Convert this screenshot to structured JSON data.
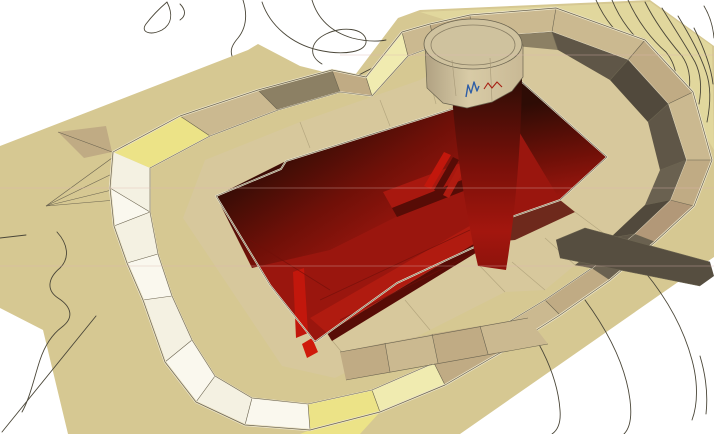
{
  "scene": {
    "kind": "3d-terrain-excavation-model",
    "description": "Isometric CAD rendering of a terrain surface with a perimeter berm, a deep rectangular excavation pit shown in red with stepped benches, and a circular shaft structure at the top edge of the pit; thin topographic contour lines cross the surrounding ground.",
    "features": {
      "terrain_surface": "tan triangulated ground surface",
      "contour_lines": "thin dark topographic contours",
      "berm_ring": "faceted embankment surrounding the excavation",
      "inner_slope": "shadowed dark olive inner slope on far side",
      "outer_slope_left": "bright white and yellow lit facets on near side",
      "excavation_pit": "deep pit with dark red floor and stepped ramps",
      "circular_shaft": "cylindrical shaft with tan collar dropping into the pit",
      "survey_marks": "small blue and red zigzag marks at shaft wall top"
    },
    "colors": {
      "bg": "#ffffff",
      "terrain": "#d6c892",
      "terrainPale": "#e3d99f",
      "bench": "#d7c89c",
      "benchLine": "#b5a77f",
      "outline": "#6b6450",
      "contour": "#4a4638",
      "toeLight": "#ece4c8",
      "crest": "#efe8d2",
      "white1": "#f4f1e2",
      "white2": "#faf8ee",
      "yellow": "#ece387",
      "yellowPale": "#f0ebb0",
      "tan1": "#cbb990",
      "tan2": "#c0ab84",
      "tan3": "#b29878",
      "brown1": "#8c8064",
      "darkOlive1": "#5f5647",
      "darkOlive2": "#51493c",
      "darkOlive3": "#6a6150",
      "rampDark": "#564e40",
      "rampLight": "#9a8e6e",
      "pitBase": "#9a160e",
      "pitBright": "#c2170c",
      "pitBright2": "#cf1a0b",
      "stepTop": "#b01b10",
      "stepTop2": "#a8180f",
      "stepSide": "#570c06",
      "wallDark": "#2e0c05",
      "wallMid": "#6f1008",
      "floorLine": "#70100a",
      "shaftTop": "#330d06",
      "shaftMid": "#7a1009",
      "shaftLow": "#a3160e",
      "shaftBase": "#8e130c",
      "cylTop": "#cfc29e",
      "cylTopLine": "#8a7f65",
      "cylBodyL": "#b0a182",
      "cylBodyM": "#d8cba6",
      "cylBodyR": "#c9b995",
      "blueMark": "#2f5ea6",
      "redMark": "#a62014",
      "artifact": "#ddb7b2"
    }
  }
}
